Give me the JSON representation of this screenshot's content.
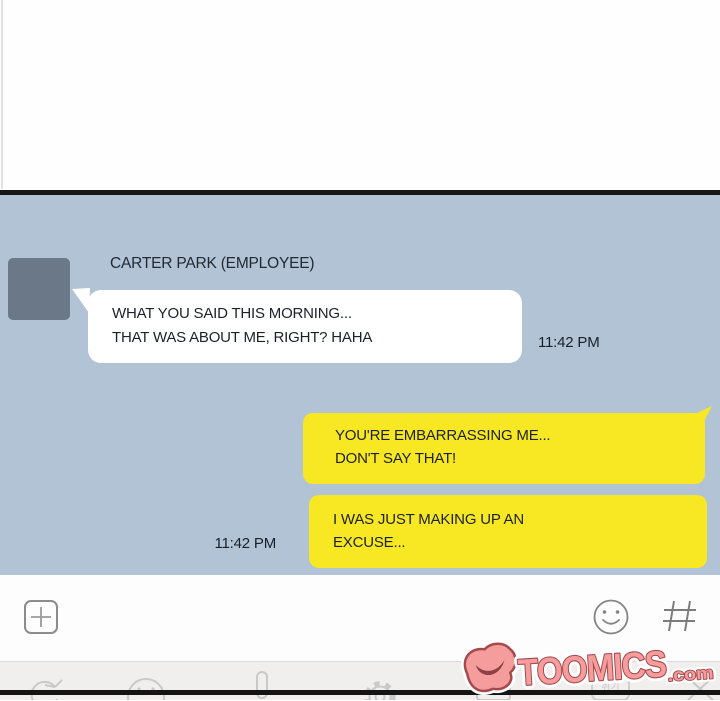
{
  "chat": {
    "sender": {
      "name": "CARTER PARK (EMPLOYEE)"
    },
    "messages": [
      {
        "side": "left",
        "lines": [
          "WHAT YOU SAID THIS MORNING...",
          "THAT WAS ABOUT ME, RIGHT? HAHA"
        ],
        "time": "11:42 PM",
        "bubble_color": "#ffffff"
      },
      {
        "side": "right",
        "lines": [
          "YOU'RE EMBARRASSING ME...",
          "DON'T SAY THAT!"
        ],
        "time": "",
        "bubble_color": "#f8e723"
      },
      {
        "side": "right",
        "lines": [
          "I WAS JUST MAKING UP AN",
          "EXCUSE..."
        ],
        "time": "11:42 PM",
        "bubble_color": "#f8e723"
      }
    ]
  },
  "toolbar": {
    "icons": [
      "plus-attach",
      "emoji-smiley",
      "hashtag"
    ]
  },
  "keyboard_bar": {
    "key_label": "취기",
    "icons": [
      "refresh",
      "emoji-smiley",
      "microphone",
      "settings-gear",
      "keyboard-switch",
      "korean-key",
      "close-x"
    ]
  },
  "watermark": {
    "brand": "TOOMICS",
    "suffix": ".com",
    "fill": "#f49d9c",
    "outline": "#a5494d"
  },
  "colors": {
    "chat_background": "#b1c3d5",
    "avatar": "#6b7888",
    "yellow_bubble": "#f8e723",
    "white_bubble": "#ffffff",
    "panel_border": "#141414",
    "toolbar_background": "#fdfdfd",
    "keyboard_background": "#f0efee",
    "toolbar_icon_gray": "#8a8a8a",
    "keyboard_icon_gray": "#cbcbcb",
    "text": "#1c222a"
  }
}
